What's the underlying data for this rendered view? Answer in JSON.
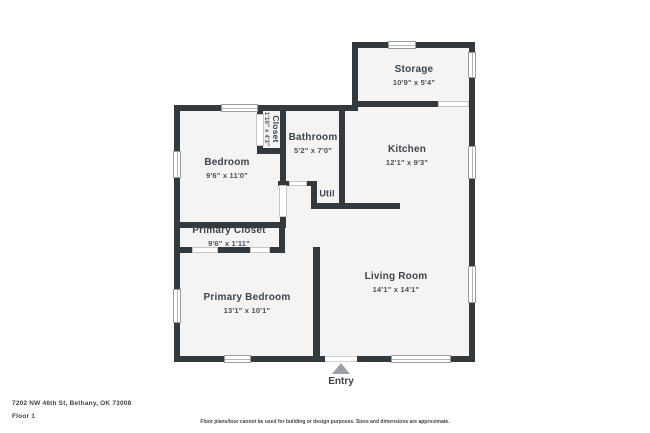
{
  "floorplan": {
    "rooms": {
      "storage": {
        "name": "Storage",
        "dims": "10'9\" x 5'4\""
      },
      "bedroom": {
        "name": "Bedroom",
        "dims": "9'6\" x 11'0\""
      },
      "closet": {
        "name": "Closet",
        "dims": "1'10\" x 4'3\""
      },
      "bathroom": {
        "name": "Bathroom",
        "dims": "5'2\" x 7'0\""
      },
      "kitchen": {
        "name": "Kitchen",
        "dims": "12'1\" x 9'3\""
      },
      "util": {
        "name": "Util"
      },
      "primary_closet": {
        "name": "Primary Closet",
        "dims": "9'6\" x 1'11\""
      },
      "primary_bedroom": {
        "name": "Primary Bedroom",
        "dims": "13'1\" x 10'1\""
      },
      "living_room": {
        "name": "Living Room",
        "dims": "14'1\" x 14'1\""
      }
    },
    "entry": {
      "label": "Entry"
    }
  },
  "footer": {
    "address": "7202 NW 46th St, Bethany, OK 73008",
    "floor": "Floor 1",
    "disclaimer": "Floor plans/tour cannot be used for building or design purposes. Sizes and dimensions are approximate."
  },
  "colors": {
    "wall": "#34393e",
    "floor": "#f4f4f4",
    "label_text": "#3d444a",
    "window_border": "#9b9b9b",
    "entry_arrow": "#9aa0a6"
  }
}
